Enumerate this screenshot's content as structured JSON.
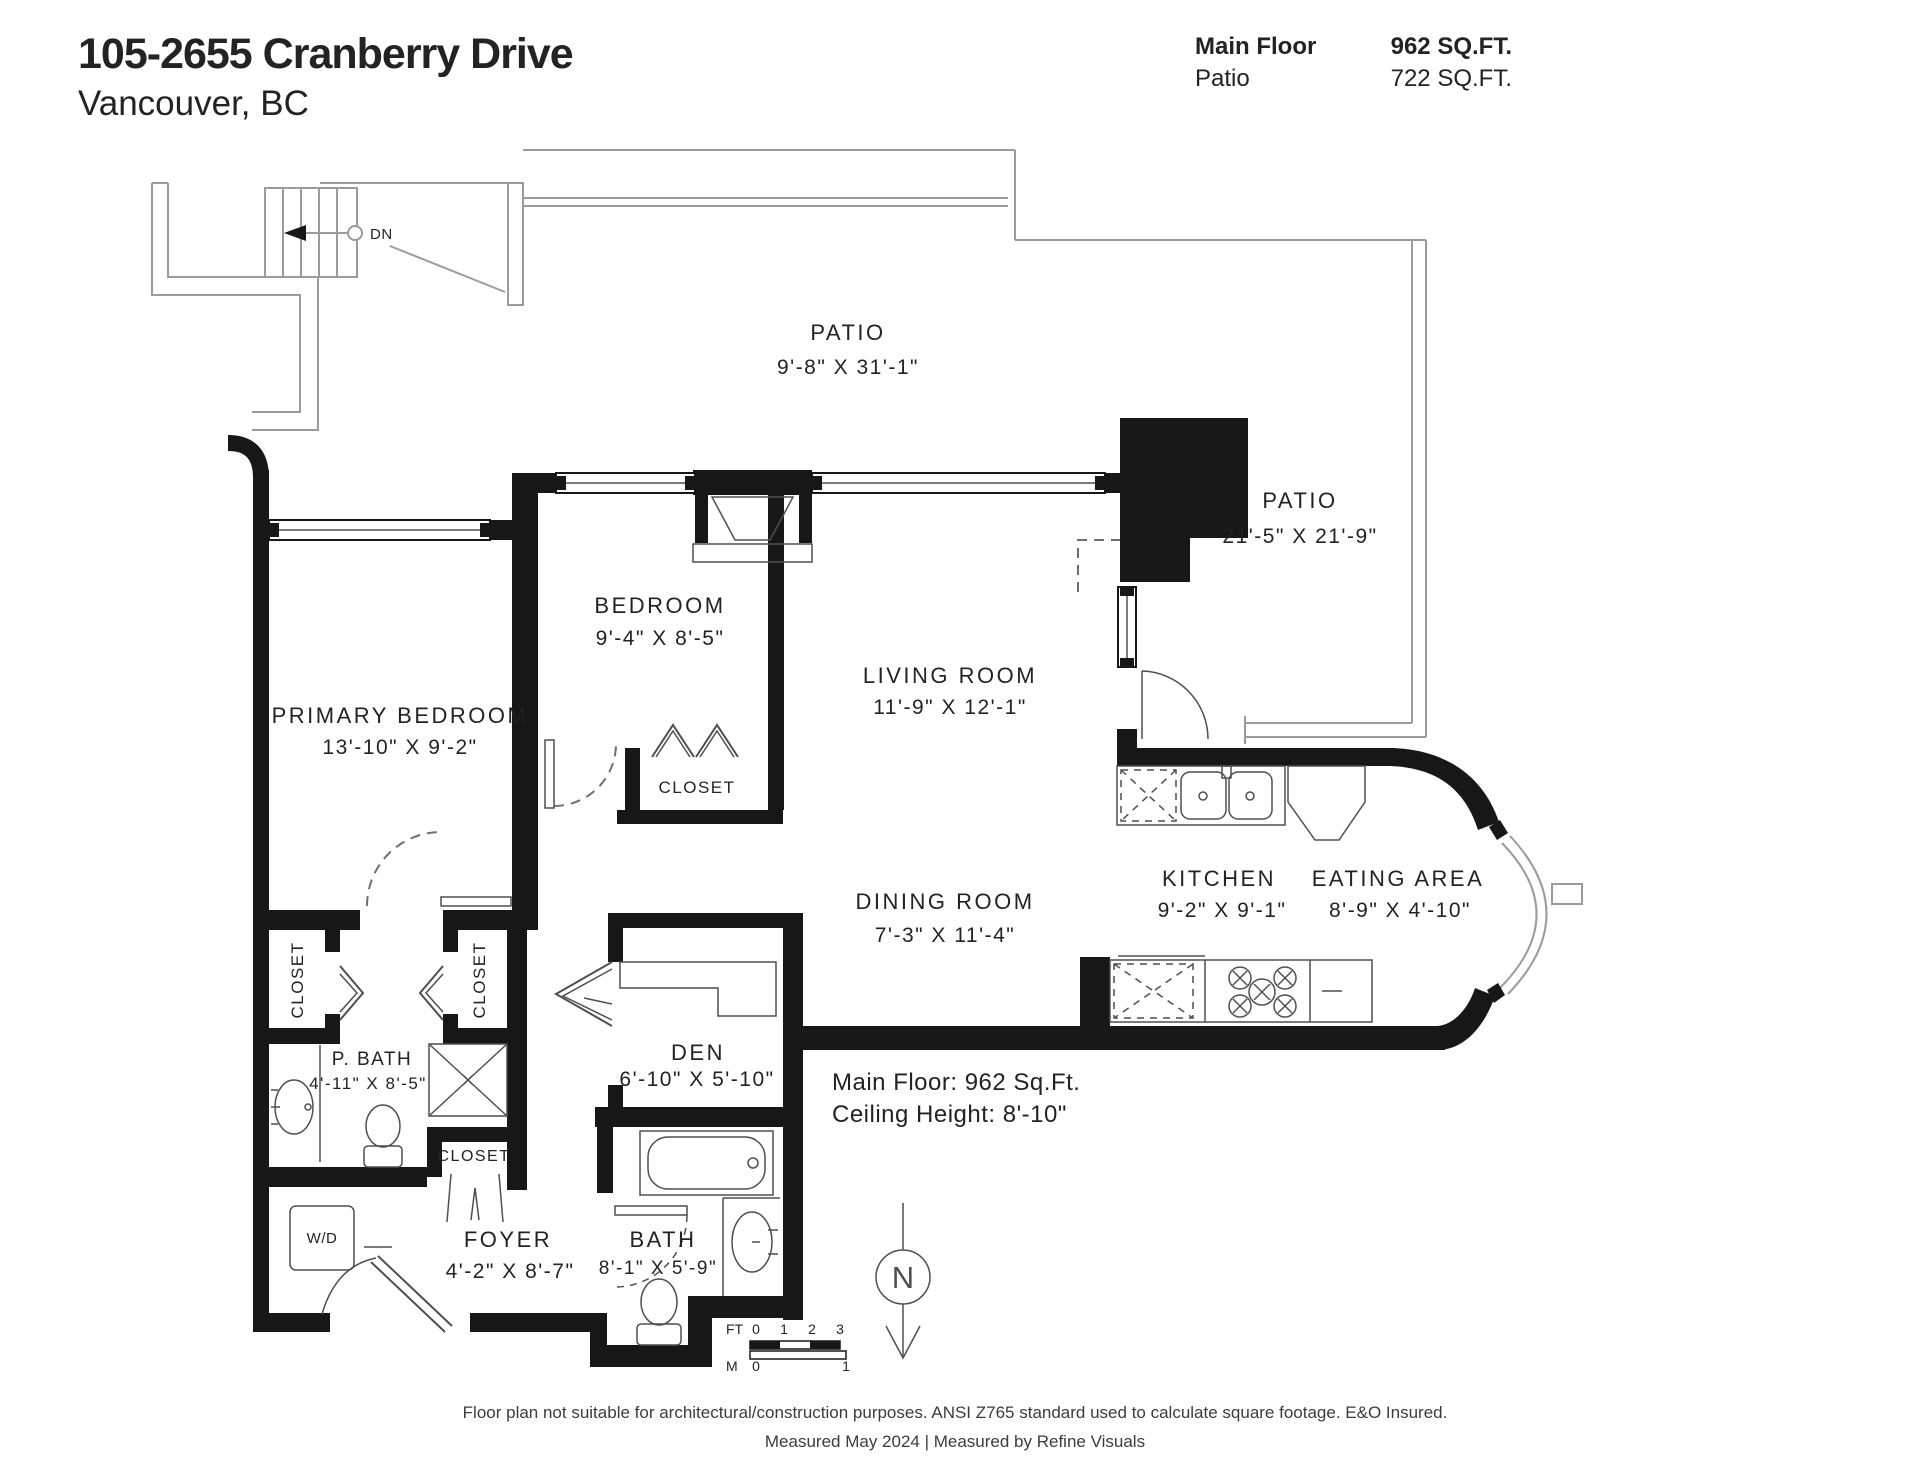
{
  "header": {
    "address": "105-2655 Cranberry Drive",
    "city": "Vancouver, BC"
  },
  "areas": {
    "rows": [
      {
        "label": "Main Floor",
        "value": "962 SQ.FT."
      },
      {
        "label": "Patio",
        "value": "722 SQ.FT."
      }
    ]
  },
  "rooms": {
    "patio_top": {
      "name": "PATIO",
      "dims": "9'-8\" X 31'-1\""
    },
    "patio_right": {
      "name": "PATIO",
      "dims": "21'-5\" X 21'-9\""
    },
    "bedroom": {
      "name": "BEDROOM",
      "dims": "9'-4\" X 8'-5\""
    },
    "living": {
      "name": "LIVING ROOM",
      "dims": "11'-9\" X 12'-1\""
    },
    "primary": {
      "name": "PRIMARY BEDROOM",
      "dims": "13'-10\" X 9'-2\""
    },
    "dining": {
      "name": "DINING ROOM",
      "dims": "7'-3\" X 11'-4\""
    },
    "kitchen": {
      "name": "KITCHEN",
      "dims": "9'-2\" X 9'-1\""
    },
    "eating": {
      "name": "EATING AREA",
      "dims": "8'-9\" X 4'-10\""
    },
    "pbath": {
      "name": "P. BATH",
      "dims": "4'-11\" X 8'-5\""
    },
    "den": {
      "name": "DEN",
      "dims": "6'-10\" X 5'-10\""
    },
    "bath": {
      "name": "BATH",
      "dims": "8'-1\" X 5'-9\""
    },
    "foyer": {
      "name": "FOYER",
      "dims": "4'-2\" X 8'-7\""
    },
    "closet_bedroom": {
      "name": "CLOSET"
    },
    "closet_primary_left": {
      "name": "CLOSET"
    },
    "closet_primary_right": {
      "name": "CLOSET"
    },
    "closet_hall": {
      "name": "CLOSET"
    },
    "laundry": {
      "name": "W/D"
    }
  },
  "annotations": {
    "stairs_down": "DN",
    "north": "N",
    "floor_note_line1": "Main Floor: 962 Sq.Ft.",
    "floor_note_line2": "Ceiling Height: 8'-10\"",
    "scale": {
      "ft_label": "FT",
      "m_label": "M",
      "ft_ticks": [
        "0",
        "1",
        "2",
        "3"
      ],
      "m_ticks": [
        "0",
        "1"
      ]
    }
  },
  "footer": {
    "line1": "Floor plan not suitable for architectural/construction purposes. ANSI Z765 standard used to calculate square footage. E&O Insured.",
    "line2": "Measured May 2024 | Measured by Refine Visuals"
  },
  "colors": {
    "wall": "#171717",
    "thin_line": "#4f4f4f",
    "patio_line": "#9b9b9b",
    "text": "#232323"
  }
}
